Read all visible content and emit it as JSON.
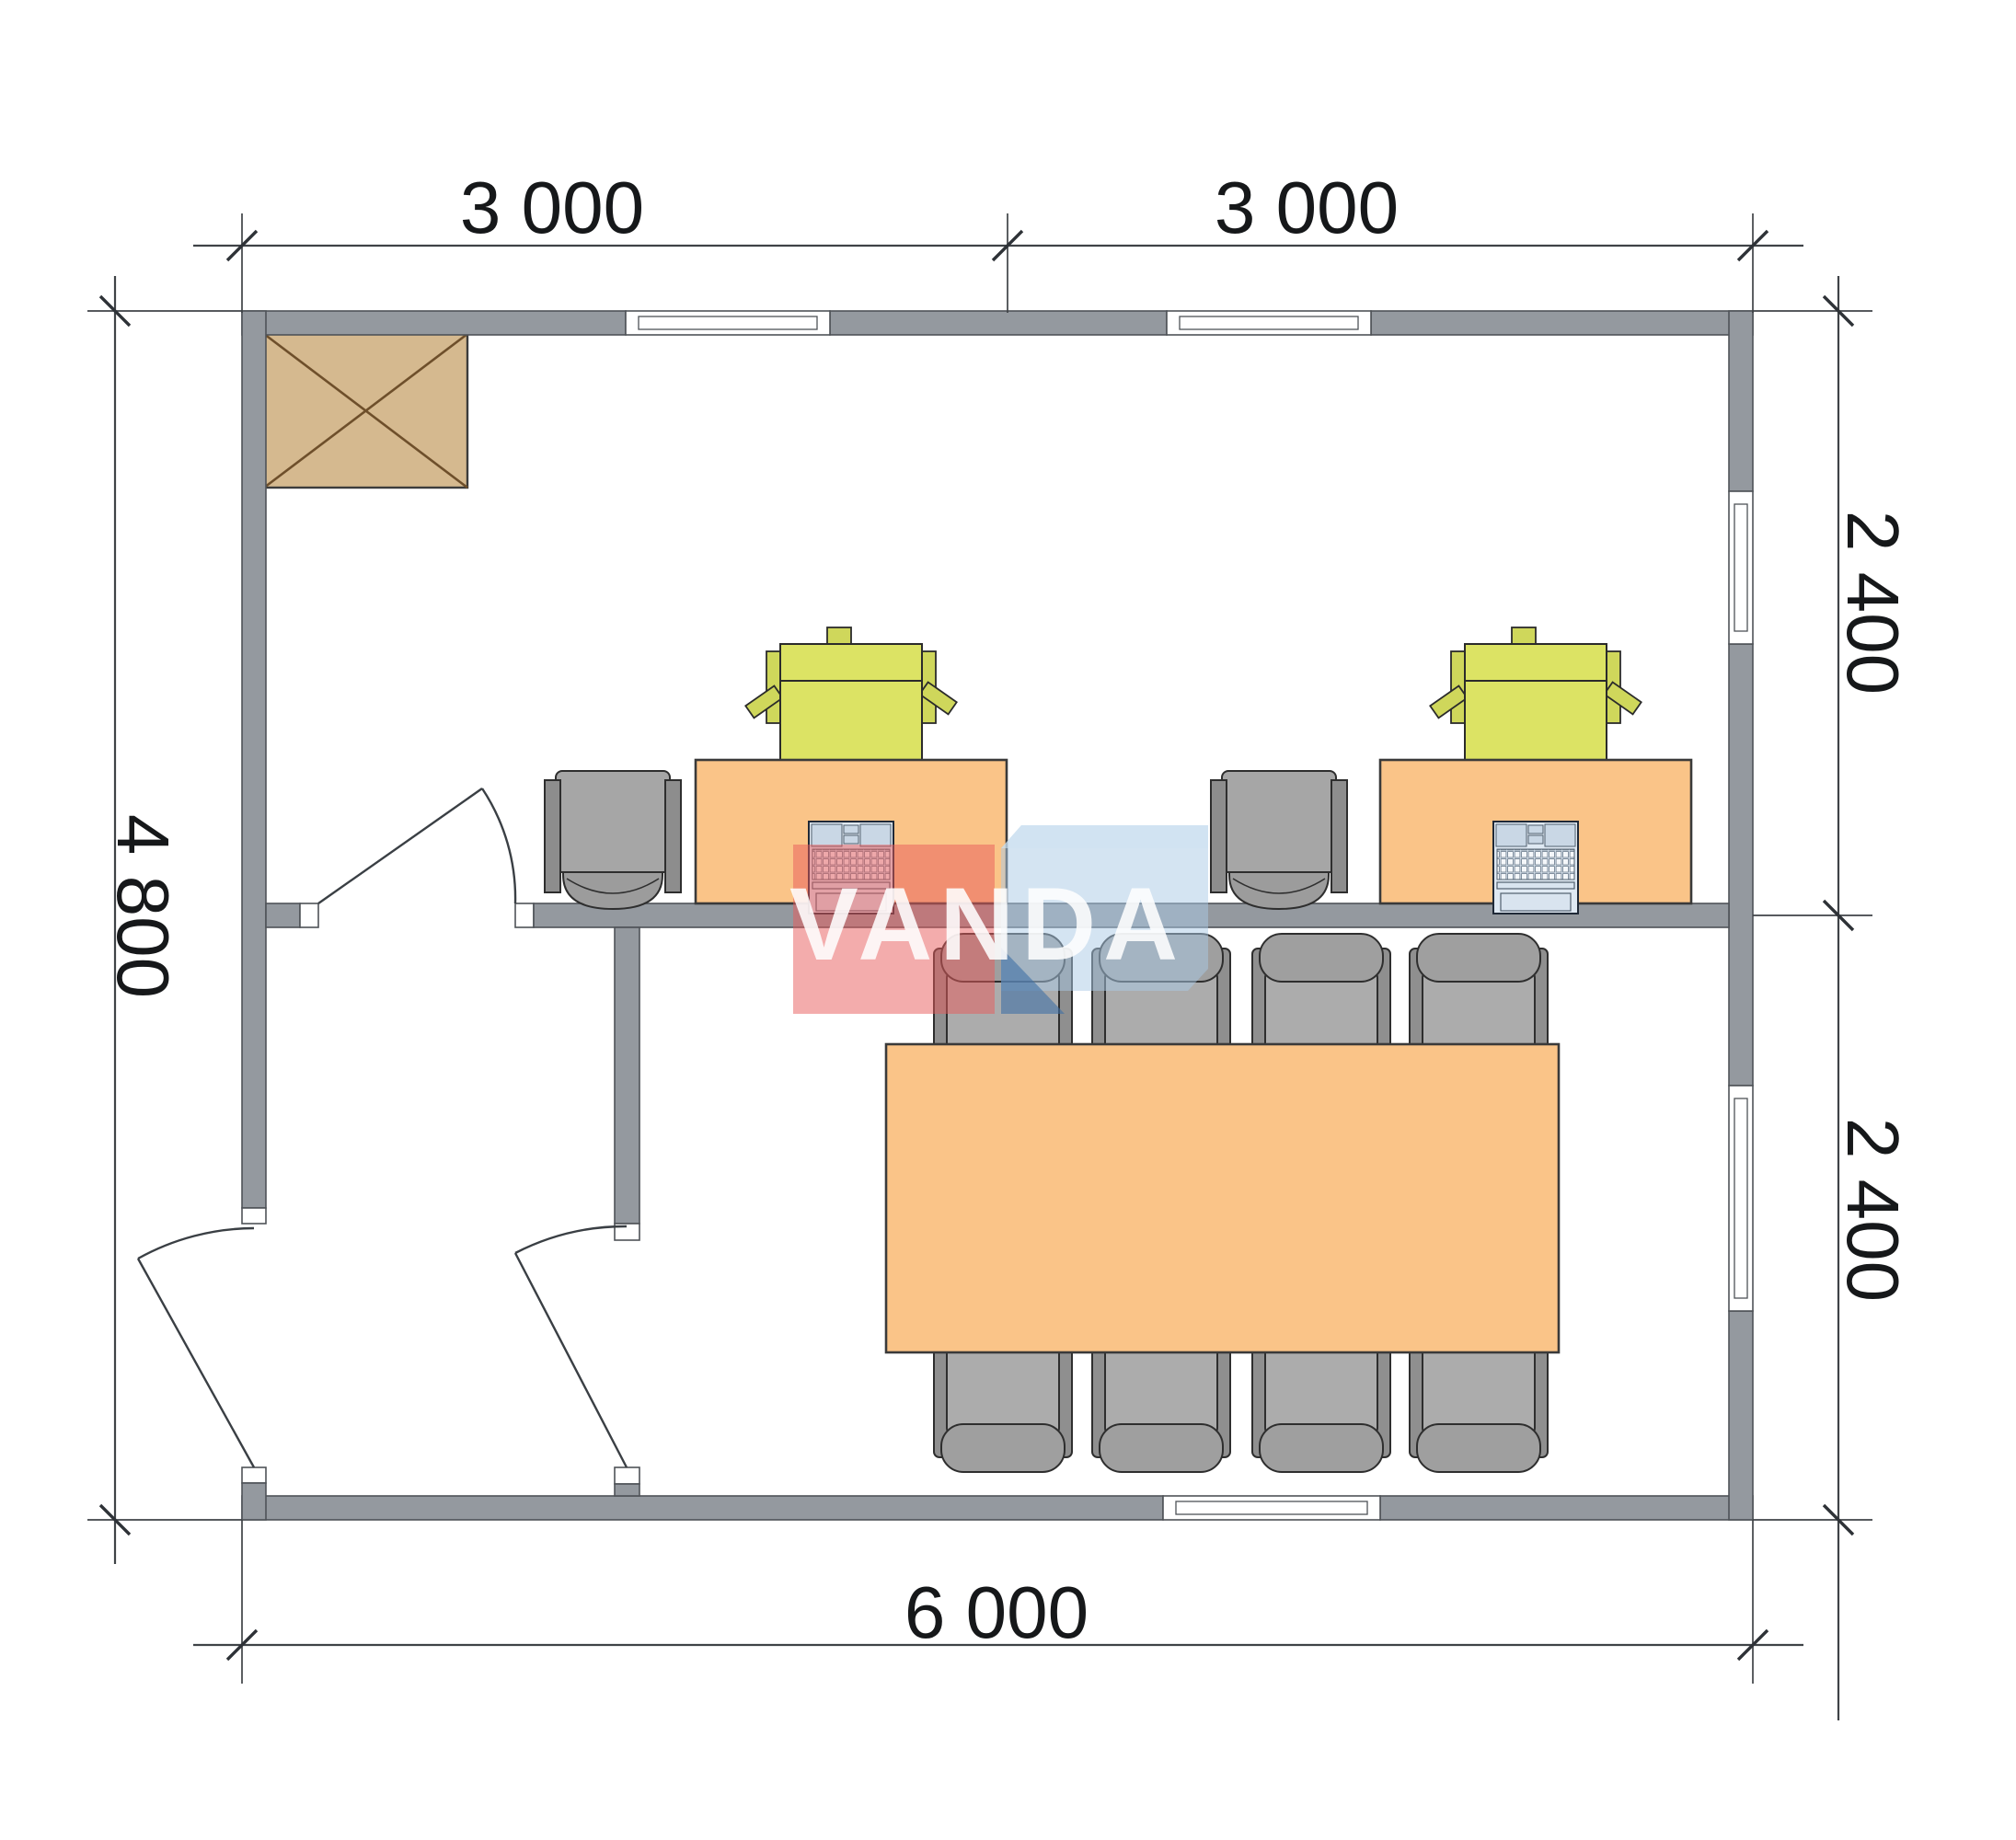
{
  "floor_plan": {
    "dimensions": {
      "top_left": "3 000",
      "top_right": "3 000",
      "left": "4 800",
      "right_upper": "2 400",
      "right_lower": "2 400",
      "bottom": "6 000"
    },
    "watermark": {
      "text": "VANDA"
    },
    "colors": {
      "wall": "#94999f",
      "furniture_orange": "#fac488",
      "printer_green": "#dce364",
      "chair_gray": "#a6a6a6",
      "cabinet_tan": "#d5b98f",
      "watermark_red": "#e85a5a",
      "watermark_blue": "#a9c9e6",
      "watermark_blue_dark": "#3f6fa5",
      "dimension_text": "#16181a"
    },
    "rooms": {
      "upper": "office with 2 workstations",
      "lower": "meeting room with 8-seat table",
      "vestibule": "entry vestibule"
    }
  }
}
